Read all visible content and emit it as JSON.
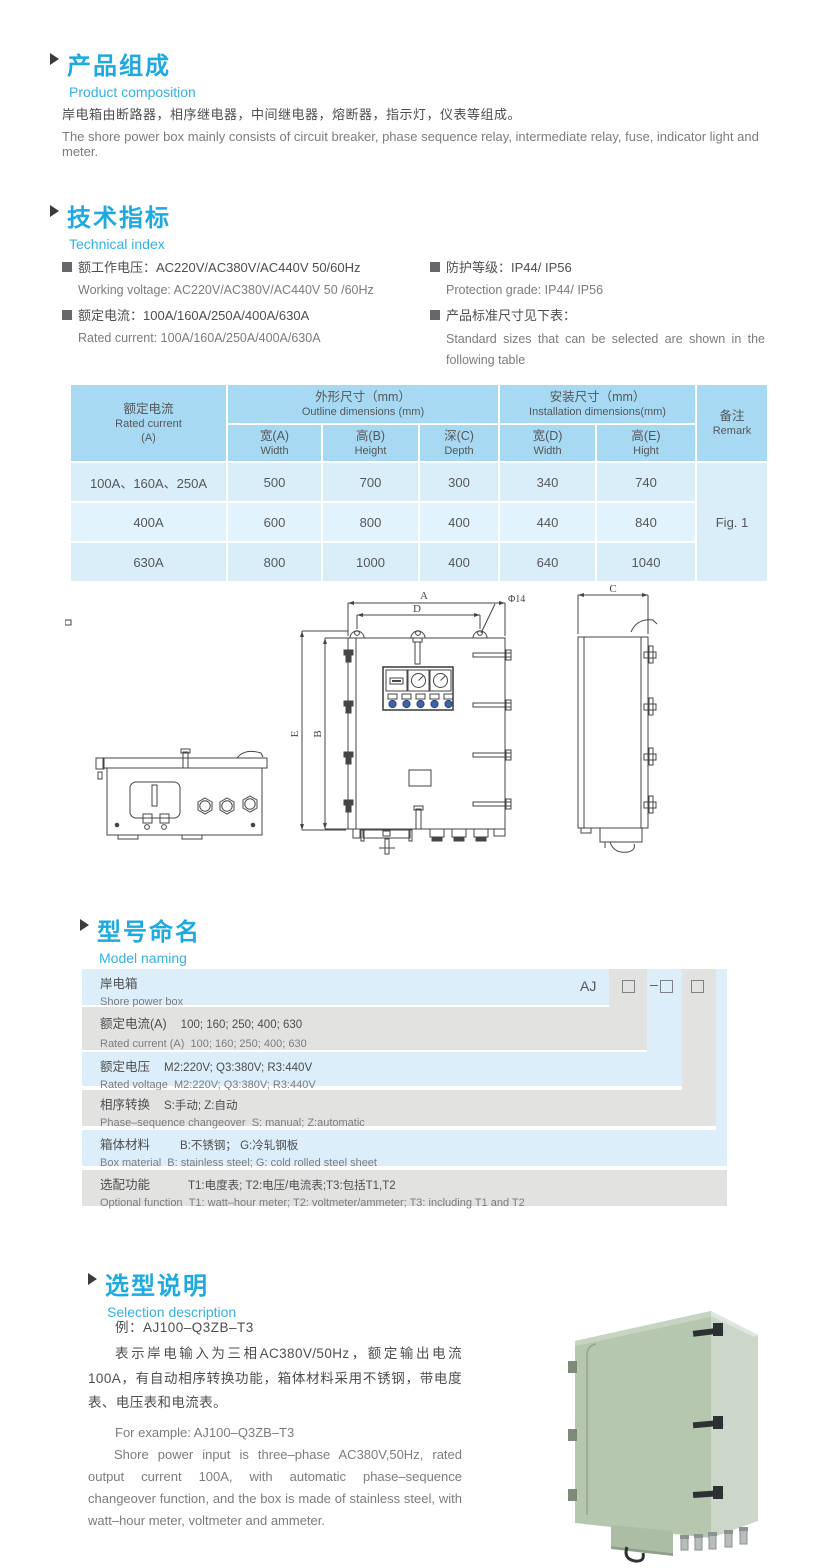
{
  "composition": {
    "heading_cn": "产品组成",
    "heading_en": "Product  composition",
    "body_cn": "岸电箱由断路器，相序继电器，中间继电器，熔断器，指示灯，仪表等组成。",
    "body_en": "The shore power box mainly consists of circuit breaker, phase sequence relay, intermediate relay, fuse, indicator light and meter."
  },
  "technical": {
    "heading_cn": "技术指标",
    "heading_en": "Technical index",
    "items": [
      {
        "cn": "额工作电压：AC220V/AC380V/AC440V  50/60Hz",
        "en": "Working voltage: AC220V/AC380V/AC440V 50 /60Hz"
      },
      {
        "cn": "额定电流：100A/160A/250A/400A/630A",
        "en": "Rated current: 100A/160A/250A/400A/630A"
      },
      {
        "cn": "防护等级：IP44/ IP56",
        "en": "Protection grade: IP44/ IP56"
      },
      {
        "cn": "产品标准尺寸见下表：",
        "en": "Standard sizes that can be selected are shown in the following table"
      }
    ]
  },
  "spec_table": {
    "type": "table",
    "col1_header": {
      "cn": "额定电流",
      "en": "Rated current",
      "unit": "(A)"
    },
    "outline_header": {
      "cn": "外形尺寸（mm）",
      "en": "Outline dimensions (mm)"
    },
    "install_header": {
      "cn": "安装尺寸（mm）",
      "en": "Installation dimensions(mm)"
    },
    "remark_header": {
      "cn": "备注",
      "en": "Remark"
    },
    "sub_headers": [
      {
        "cn": "宽(A)",
        "en": "Width"
      },
      {
        "cn": "高(B)",
        "en": "Height"
      },
      {
        "cn": "深(C)",
        "en": "Depth"
      },
      {
        "cn": "宽(D)",
        "en": "Width"
      },
      {
        "cn": "高(E)",
        "en": "Hight"
      }
    ],
    "rows": [
      {
        "current": "100A、160A、250A",
        "w": "500",
        "h": "700",
        "d": "300",
        "iw": "340",
        "ih": "740"
      },
      {
        "current": "400A",
        "w": "600",
        "h": "800",
        "d": "400",
        "iw": "440",
        "ih": "840"
      },
      {
        "current": "630A",
        "w": "800",
        "h": "1000",
        "d": "400",
        "iw": "640",
        "ih": "1040"
      }
    ],
    "remark_value": "Fig. 1"
  },
  "drawing": {
    "dim_a": "A",
    "dim_d": "D",
    "dim_b": "B",
    "dim_e": "E",
    "dim_c": "C",
    "hole_label": "Φ14"
  },
  "naming": {
    "heading_cn": "型号命名",
    "heading_en": "Model naming",
    "code": {
      "prefix": "AJ",
      "dash": "–"
    },
    "rows": [
      {
        "label_cn": "岸电箱",
        "value_cn": "",
        "label_en": "Shore power box",
        "value_en": ""
      },
      {
        "label_cn": "额定电流(A)",
        "value_cn": "100; 160; 250; 400; 630",
        "label_en": "Rated current (A)",
        "value_en": "100; 160; 250; 400; 630"
      },
      {
        "label_cn": "额定电压",
        "value_cn": "M2:220V;  Q3:380V;  R3:440V",
        "label_en": "Rated voltage",
        "value_en": "M2:220V;  Q3:380V;  R3:440V"
      },
      {
        "label_cn": "相序转换",
        "value_cn": "S:手动; Z:自动",
        "label_en": "Phase–sequence changeover",
        "value_en": "S: manual;  Z:automatic"
      },
      {
        "label_cn": "箱体材料",
        "value_cn": "B:不锈钢；  G:冷轧钢板",
        "label_en": "Box material",
        "value_en": "B: stainless steel; G: cold rolled steel sheet"
      },
      {
        "label_cn": "选配功能",
        "value_cn": "T1:电度表;  T2:电压/电流表;T3:包括T1,T2",
        "label_en": "Optional function",
        "value_en": "T1: watt–hour meter; T2: voltmeter/ammeter; T3: including T1 and T2"
      }
    ]
  },
  "selection": {
    "heading_cn": "选型说明",
    "heading_en": "Selection description",
    "example_cn": "例：AJ100–Q3ZB–T3",
    "body_cn": "表示岸电输入为三相AC380V/50Hz，额定输出电流100A，有自动相序转换功能，箱体材料采用不锈钢，带电度表、电压表和电流表。",
    "example_en": "For example: AJ100–Q3ZB–T3",
    "body_en": "Shore power input is three–phase AC380V,50Hz, rated output current 100A, with automatic phase–sequence changeover function, and the box is made of stainless steel, with watt–hour meter, voltmeter and ammeter."
  }
}
